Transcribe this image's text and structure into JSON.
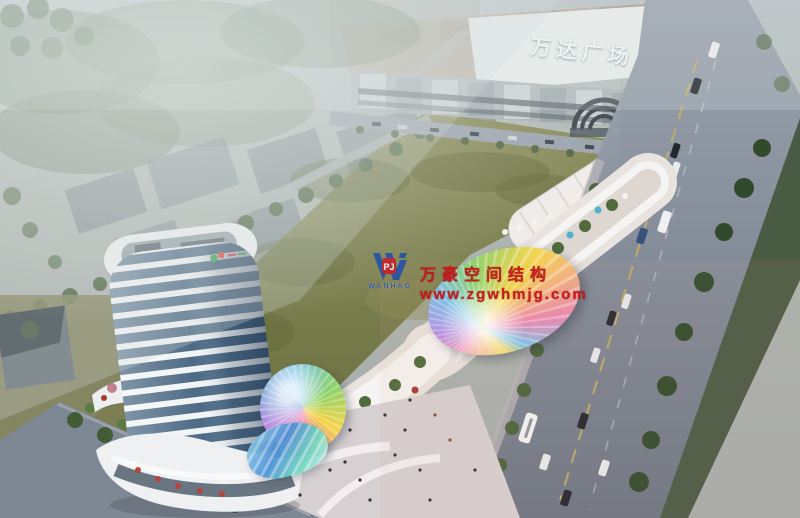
{
  "scene": {
    "type": "aerial architectural rendering",
    "description": "Bird's-eye dusk rendering of a mixed-use retail plaza: white office tower, curved retail street with rainbow fan canopy and domes, large lawn, tree-lined boulevard with traffic, and the Wanda Plaza mall behind"
  },
  "mall": {
    "sign_text": "万达广场"
  },
  "watermark": {
    "company": "万豪空间结构",
    "url": "www.zgwhmjg.com",
    "logo_word": "WANHAO",
    "logo_badge": "PJ",
    "logo_icon": "w-monogram-icon"
  },
  "colors": {
    "watermark_red": "#c81717",
    "logo_blue": "#2b55a5",
    "badge_red": "#c0272d",
    "field_green": "#7a7e4f",
    "road_grey": "#8c95a3",
    "tower_glass": "#4d6a85",
    "canopy_rainbow": [
      "#f6d44a",
      "#ef8ab0",
      "#7cc3e8",
      "#8fd36a",
      "#b78fe0"
    ]
  }
}
